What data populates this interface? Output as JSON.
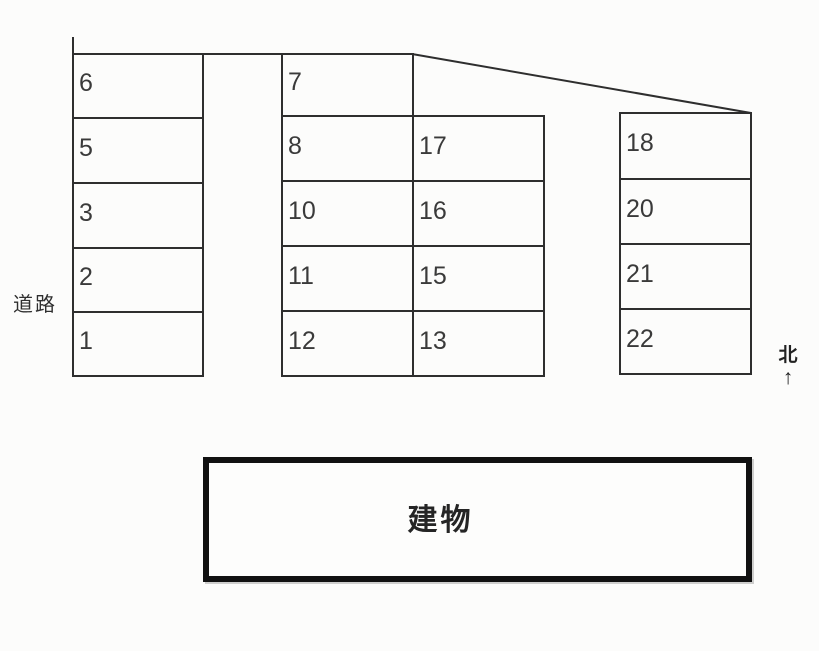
{
  "diagram": {
    "type": "parking-layout",
    "background_color": "#fcfcfb",
    "line_color": "#2e2e2e",
    "building_border_color": "#111111",
    "text_color": "#3a3a3a"
  },
  "labels": {
    "road": "道路",
    "north": "北",
    "north_arrow": "↑",
    "building": "建物"
  },
  "parking": {
    "left_column": [
      "6",
      "5",
      "3",
      "2",
      "1"
    ],
    "middle_left_column": [
      "7",
      "8",
      "10",
      "11",
      "12"
    ],
    "middle_right_column": [
      "17",
      "16",
      "15",
      "13"
    ],
    "right_column": [
      "18",
      "20",
      "21",
      "22"
    ]
  }
}
